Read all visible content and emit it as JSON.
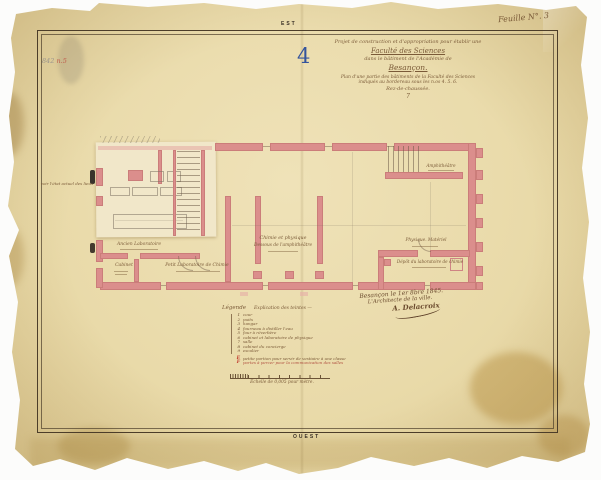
{
  "colors": {
    "paper": "#e9daa9",
    "ink": "#7a5a38",
    "wall_pink": "#db8e8c",
    "blue_number": "#33539c",
    "red_accent": "#c0392b"
  },
  "sheet": {
    "compass_top": "EST",
    "compass_bottom": "OUEST",
    "sheet_number": "Feuille N°. 3",
    "archive_note_gray": "842",
    "archive_note_red": "n.5",
    "plan_number": "4"
  },
  "title_block": {
    "line1": "Projet de construction et d'appropriation pour établir une",
    "line2": "Faculté des Sciences",
    "line3": "dans le bâtiment de l'Académie de",
    "line4": "Besançon.",
    "line5": "Plan d'une partie des bâtiments de la Faculté des Sciences",
    "line6": "indiqués au bordereau sous les n.os 4. 5. 6.",
    "line7": "Rez-de-chaussée.",
    "mark": "7"
  },
  "plan": {
    "labels": {
      "exterior_note": "voir l'état actuel des lieux",
      "room_ancien_lab": "Ancien Laboratoire",
      "room_cabinet": "Cabinet",
      "room_petit_lab": "Petit Laboratoire de Chimie",
      "room_center_1": "Chimie et physique",
      "room_center_2": "Dessous de l'amphithéâtre",
      "room_amphi": "Amphithéâtre",
      "room_physique": "Physique. Matériel",
      "room_depot": "Dépôt du laboratoire de chimie"
    }
  },
  "legend": {
    "heading": "Légende",
    "heading2": "Explication des teintes —",
    "items": [
      {
        "num": "1",
        "text": "cour"
      },
      {
        "num": "2",
        "text": "puits"
      },
      {
        "num": "3",
        "text": "hangar"
      },
      {
        "num": "4",
        "text": "fourneau à distiller l'eau"
      },
      {
        "num": "5",
        "text": "four à réverbère"
      },
      {
        "num": "6",
        "text": "cabinet et laboratoire de physique"
      },
      {
        "num": "7",
        "text": "salle"
      },
      {
        "num": "8",
        "text": "cabinet du concierge"
      },
      {
        "num": "9",
        "text": "escalier"
      }
    ],
    "red_items": [
      {
        "letter": "E",
        "text": "petite portion pour servir de vestiaire à une classe"
      },
      {
        "letter": "F",
        "text": "portes à percer pour la communication des salles"
      }
    ]
  },
  "signature": {
    "line1": "Besançon le 1er 8bre 1845.",
    "line2": "L'Architecte de la ville.",
    "line3": "A. Delacroix"
  },
  "scale": {
    "label": "Échelle de 0,005 pour mètre."
  }
}
